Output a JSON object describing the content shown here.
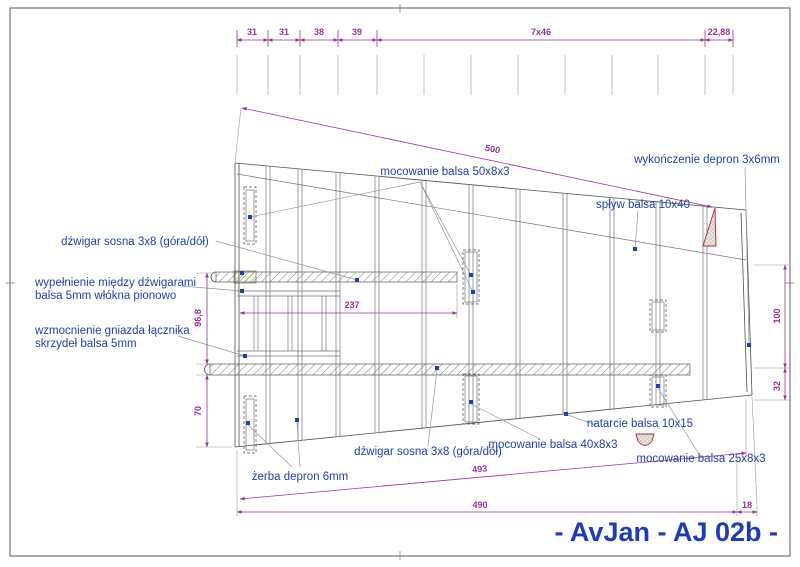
{
  "drawing": {
    "title": "- AvJan - AJ 02b -",
    "annotations": {
      "mocowanie_50": "mocowanie balsa 50x8x3",
      "wykonczenie": "wykończenie depron 3x6mm",
      "splyw": "spływ balsa 10x40",
      "dzwigar_top": "dźwigar sosna 3x8 (góra/dół)",
      "wypelnienie_l1": "wypełnienie między dźwigarami",
      "wypelnienie_l2": "balsa 5mm włókna pionowo",
      "wzmocnienie_l1": "wzmocnienie gniazda łącznika",
      "wzmocnienie_l2": "skrzydeł balsa 5mm",
      "zerba": "żerba depron 6mm",
      "dzwigar_bottom": "dźwigar sosna 3x8 (góra/dół)",
      "mocowanie_40": "mocowanie balsa 40x8x3",
      "natarcie": "natarcie balsa 10x15",
      "mocowanie_25": "mocowanie balsa 25x8x3"
    },
    "dimensions": {
      "chain": [
        "31",
        "31",
        "38",
        "39",
        "7x46",
        "22,88"
      ],
      "span_diag": "500",
      "spar_length": "237",
      "root_upper": "96,8",
      "root_lower": "70",
      "tip_upper": "100",
      "tip_lower": "32",
      "leading_diag": "493",
      "bottom_total": "490",
      "tip_offset": "18"
    },
    "colors": {
      "dimension": "#9c2f9c",
      "label": "#1e3eb8",
      "structure": "#4d4d55",
      "detail_red": "#c03030"
    }
  }
}
